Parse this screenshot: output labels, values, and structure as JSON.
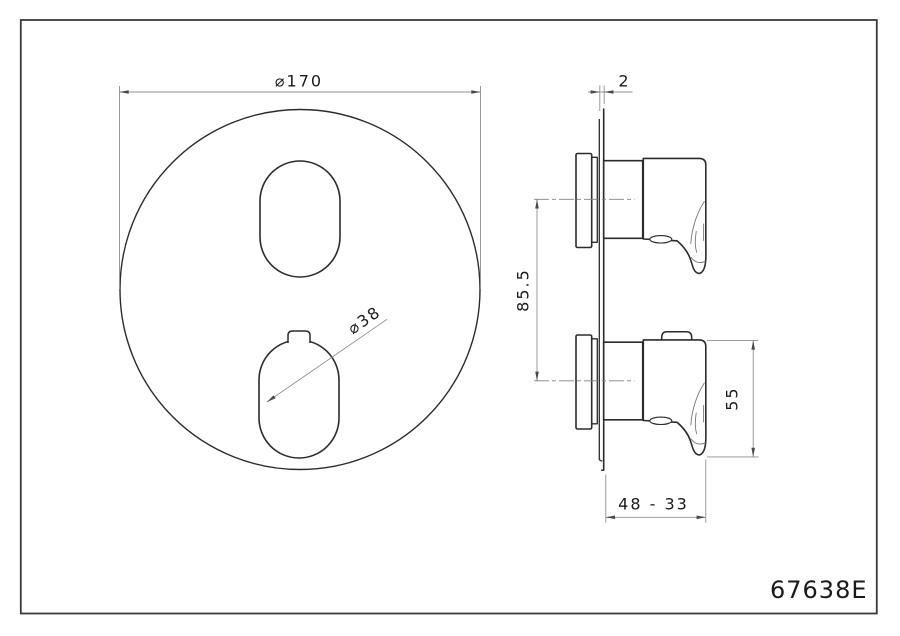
{
  "drawing": {
    "part_number": "67638E",
    "front_view": {
      "plate_diameter_label": "⌀170",
      "knob_diameter_label": "⌀38"
    },
    "side_view": {
      "plate_thickness_label": "2",
      "handle_spacing_label": "85.5",
      "handle_height_label": "55",
      "depth_range_label": "48 - 33"
    },
    "colors": {
      "background": "#ffffff",
      "border": "#3a3a3a",
      "object_line": "#2b2b2b",
      "dimension_line": "#8f8f8f",
      "text": "#1a1a1a"
    }
  }
}
